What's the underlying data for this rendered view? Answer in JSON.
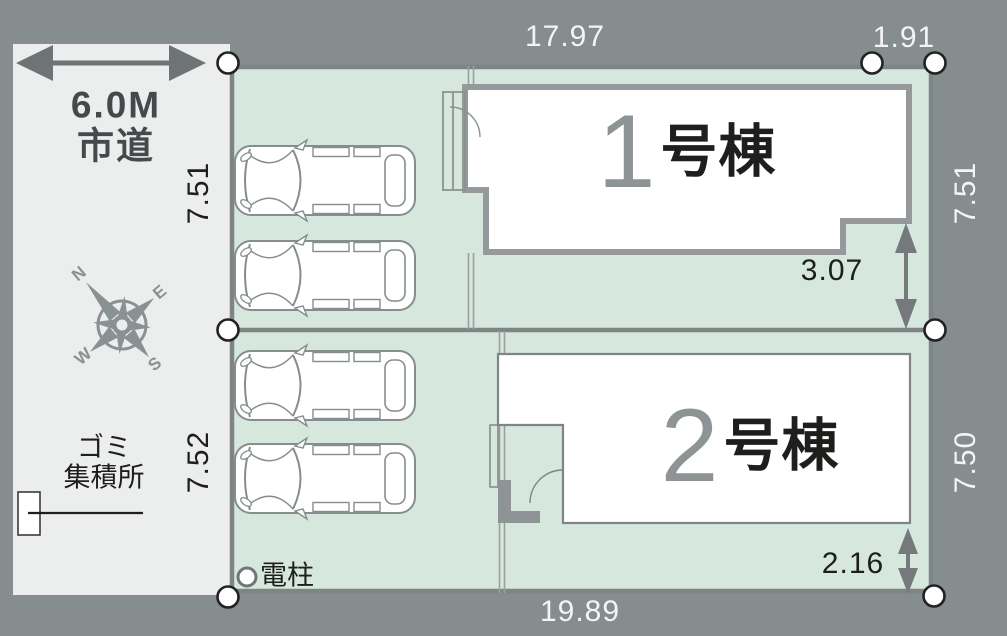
{
  "road": {
    "width_label": "6.0M",
    "type_label": "市道"
  },
  "dims": {
    "top_width": "17.97",
    "top_offset": "1.91",
    "lot1_left": "7.51",
    "lot1_right": "7.51",
    "lot1_gap": "3.07",
    "lot2_left": "7.52",
    "lot2_right": "7.50",
    "lot2_gap": "2.16",
    "bottom_width": "19.89"
  },
  "buildings": [
    {
      "number": "1",
      "suffix": "号棟"
    },
    {
      "number": "2",
      "suffix": "号棟"
    }
  ],
  "garbage_station": {
    "line1": "ゴミ",
    "line2": "集積所"
  },
  "utility_pole": "電柱",
  "compass": {
    "n": "N",
    "e": "E",
    "s": "S",
    "w": "W"
  },
  "colors": {
    "frame_gray": "#868D8F",
    "road_gray": "#ECEDED",
    "plot_green": "#D6E8DE",
    "line_gray": "#7F8587",
    "building1_border": "#95999B",
    "car_outline": "#868D8F",
    "label_white": "#F3F4F4",
    "label_black": "#1E1E1C",
    "number_gray": "#8E9496"
  }
}
